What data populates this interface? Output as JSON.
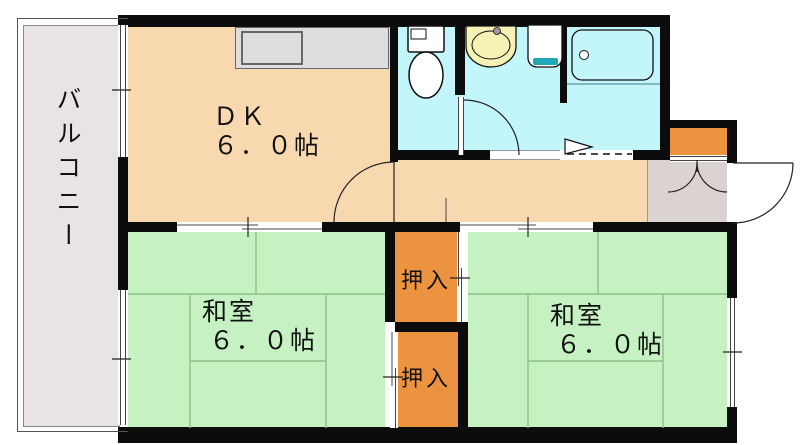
{
  "plan_title": "1DK apartment floor plan",
  "palette": {
    "wall": "#0c0c0c",
    "peach": "#f8d8af",
    "green": "#c6f2c3",
    "tatami": "#8cbf8c",
    "orange": "#ec9340",
    "cyan": "#c3f6fa",
    "balcony": "#e9e3e3",
    "genkan": "#dbd2d2",
    "counter": "#dedede",
    "basin": "#f6f2b6",
    "teal": "#1fa8b8",
    "line": "#222222"
  },
  "rooms": {
    "balcony": {
      "label": "バルコニー"
    },
    "dk": {
      "label": "ＤＫ",
      "size": "６．０帖"
    },
    "washitsu_left": {
      "label": "和室",
      "size": "６．０帖"
    },
    "washitsu_right": {
      "label": "和室",
      "size": "６．０帖"
    },
    "closet_top": {
      "label": "押入"
    },
    "closet_bottom": {
      "label": "押入"
    }
  }
}
